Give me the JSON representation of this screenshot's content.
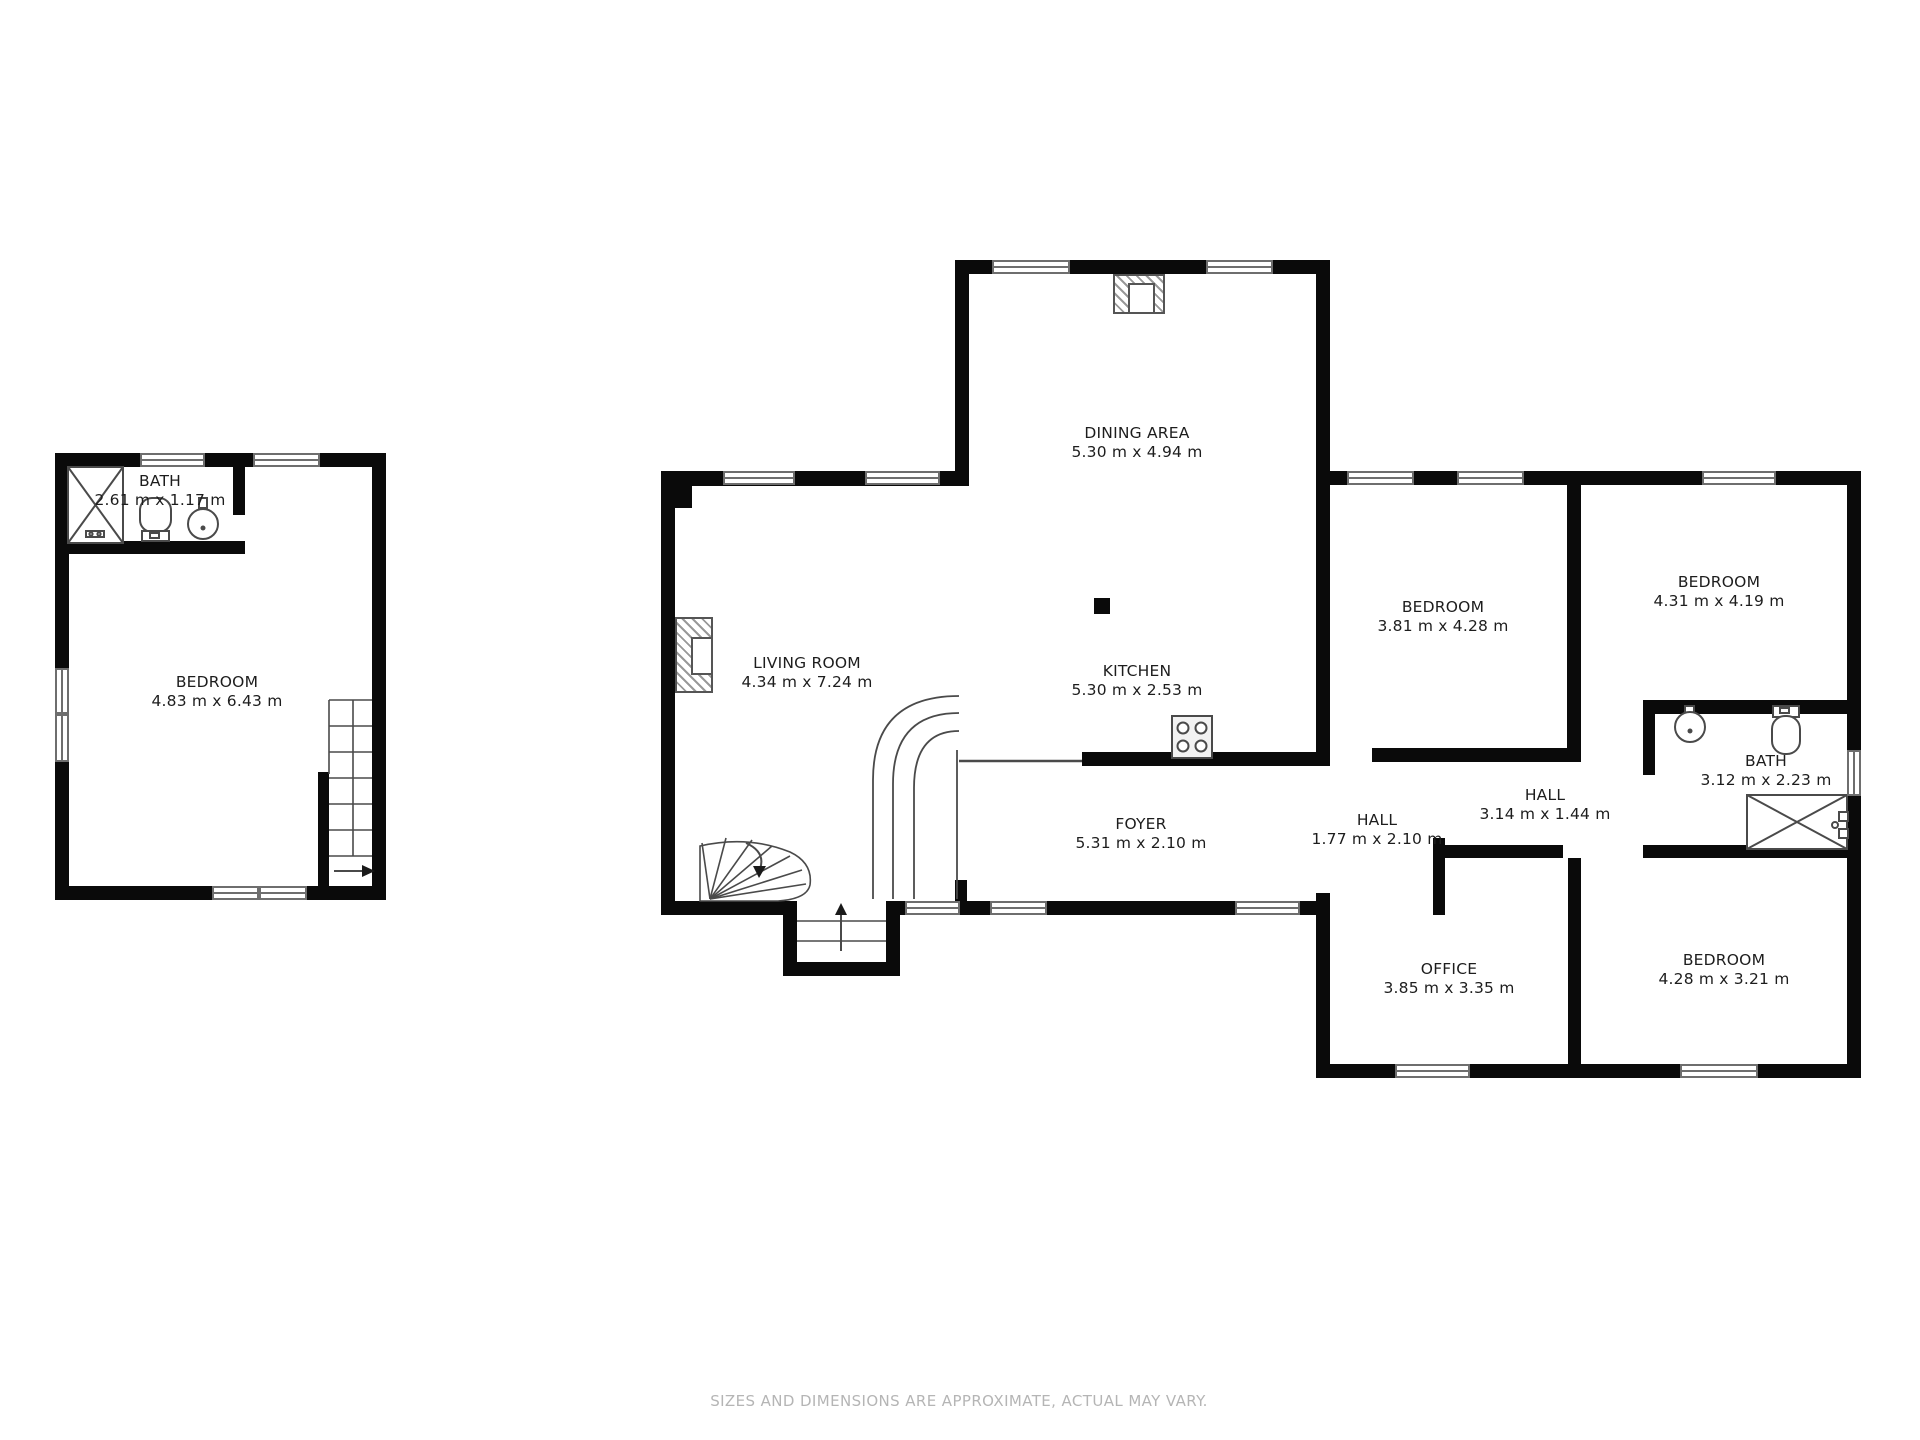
{
  "page": {
    "title": "Floor plan",
    "disclaimer": "SIZES AND DIMENSIONS ARE APPROXIMATE, ACTUAL MAY VARY."
  },
  "colors": {
    "wall": "#0a0a0a",
    "window_frame": "#6e6e6e",
    "fixture_line": "#4a4a4a",
    "text": "#1d1d1d",
    "muted_text": "#b5b5b5",
    "background": "#ffffff"
  },
  "icons": [
    "shower-icon",
    "toilet-icon",
    "sink-icon",
    "bathtub-icon",
    "stove-icon",
    "stairs-icon",
    "winder-stairs-icon",
    "entry-steps-icon",
    "chimney-icon",
    "direction-arrow-icon"
  ],
  "rooms": [
    {
      "id": "bath-upper-unit",
      "name": "BATH",
      "dims": "2.61 m x 1.17 m"
    },
    {
      "id": "bedroom-upper-unit",
      "name": "BEDROOM",
      "dims": "4.83 m x 6.43 m"
    },
    {
      "id": "dining-area",
      "name": "DINING AREA",
      "dims": "5.30 m x 4.94 m"
    },
    {
      "id": "living-room",
      "name": "LIVING ROOM",
      "dims": "4.34 m x 7.24 m"
    },
    {
      "id": "kitchen",
      "name": "KITCHEN",
      "dims": "5.30 m x 2.53 m"
    },
    {
      "id": "foyer",
      "name": "FOYER",
      "dims": "5.31 m x 2.10 m"
    },
    {
      "id": "hall-small",
      "name": "HALL",
      "dims": "1.77 m x 2.10 m"
    },
    {
      "id": "hall-long",
      "name": "HALL",
      "dims": "3.14 m x 1.44 m"
    },
    {
      "id": "bedroom-west",
      "name": "BEDROOM",
      "dims": "3.81 m x 4.28 m"
    },
    {
      "id": "bedroom-northeast",
      "name": "BEDROOM",
      "dims": "4.31 m x 4.19 m"
    },
    {
      "id": "bath-east",
      "name": "BATH",
      "dims": "3.12 m x 2.23 m"
    },
    {
      "id": "office",
      "name": "OFFICE",
      "dims": "3.85 m x 3.35 m"
    },
    {
      "id": "bedroom-southeast",
      "name": "BEDROOM",
      "dims": "4.28 m x 3.21 m"
    }
  ]
}
